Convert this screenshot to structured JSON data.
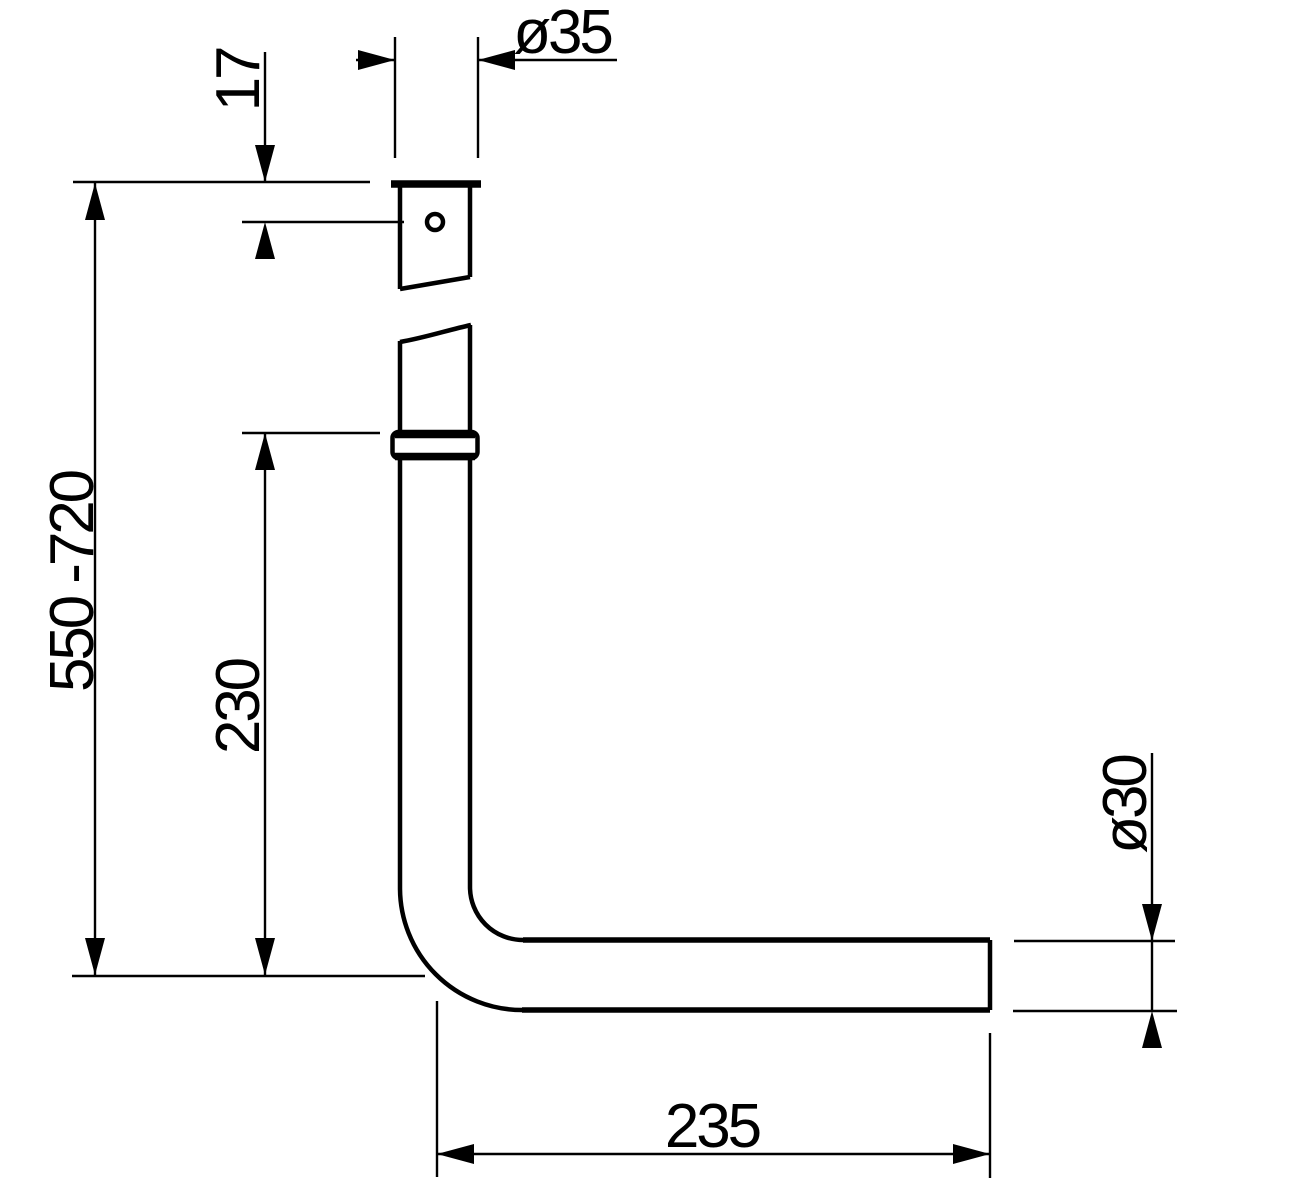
{
  "drawing": {
    "background_color": "#ffffff",
    "line_color": "#000000",
    "dimensions": {
      "top_diameter": "ø35",
      "top_hole_offset": "17",
      "overall_height_range": "550 -720",
      "vertical_section_length": "230",
      "outlet_diameter": "ø30",
      "horizontal_section_length": "235"
    }
  }
}
